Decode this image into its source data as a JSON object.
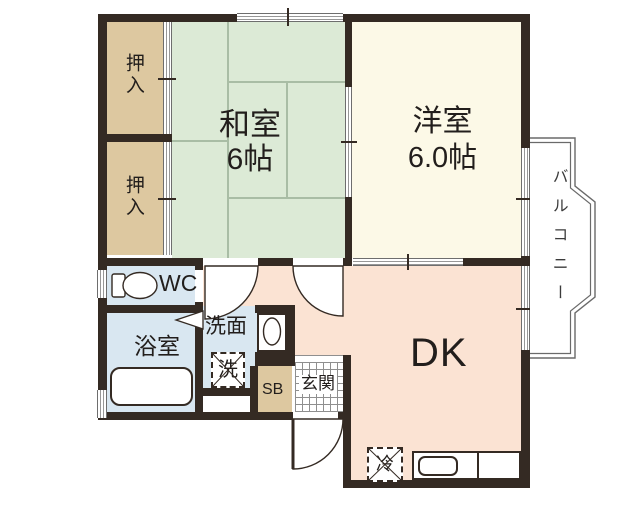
{
  "floorplan": {
    "type": "japanese-apartment-floor-plan",
    "rooms": {
      "oshiire1": {
        "label": "押入"
      },
      "oshiire2": {
        "label": "押入"
      },
      "washitsu": {
        "label": "和室",
        "size": "6帖"
      },
      "youshitsu": {
        "label": "洋室",
        "size": "6.0帖"
      },
      "balcony": {
        "label": "バルコニー"
      },
      "wc": {
        "label": "WC"
      },
      "bathroom": {
        "label": "浴室"
      },
      "washroom": {
        "label": "洗面"
      },
      "washer": {
        "label": "洗"
      },
      "shoebox": {
        "label": "SB"
      },
      "genkan": {
        "label": "玄関"
      },
      "dk": {
        "label": "DK"
      },
      "fridge": {
        "label": "冷"
      }
    },
    "colors": {
      "wall": "#342a23",
      "closet_fill": "#ddc8a0",
      "tatami_fill": "#dcead6",
      "western_room_fill": "#fcf9e7",
      "wet_area_fill": "#d9e7f1",
      "dk_fill": "#fbe3d3",
      "balcony_line": "#6a6a6a"
    }
  }
}
